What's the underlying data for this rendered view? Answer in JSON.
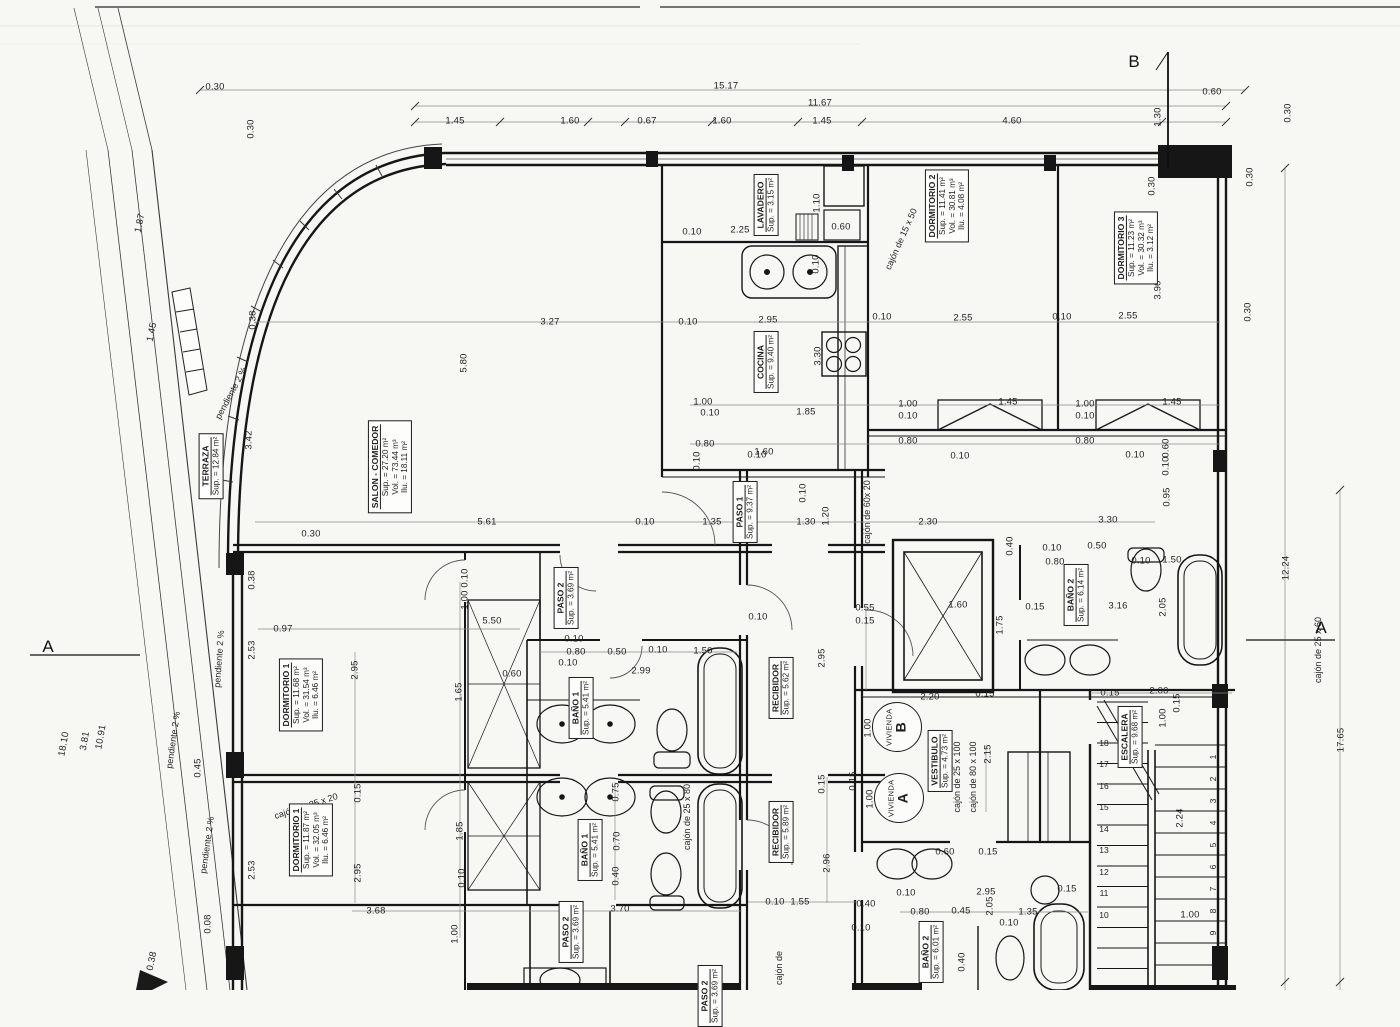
{
  "sheet": {
    "kind": "floor plan scan"
  },
  "section_letters": [
    {
      "t": "B",
      "x": 1134,
      "y": 62
    },
    {
      "t": "A",
      "x": 48,
      "y": 647
    },
    {
      "t": "A",
      "x": 1321,
      "y": 628
    }
  ],
  "rooms": [
    {
      "id": "terraza",
      "name": "TERRAZA",
      "lines": [
        "Sup. = 12.84 m²"
      ],
      "x": 211,
      "y": 466
    },
    {
      "id": "salon-comedor",
      "name": "SALON - COMEDOR",
      "lines": [
        "Sup. = 27.20 m²",
        "Vol. = 73.44 m³",
        "Ilu. = 18.11 m²"
      ],
      "x": 390,
      "y": 467
    },
    {
      "id": "lavadero",
      "name": "LAVADERO",
      "lines": [
        "Sup. = 3.15 m²"
      ],
      "x": 766,
      "y": 205
    },
    {
      "id": "cocina",
      "name": "COCINA",
      "lines": [
        "Sup. = 9.40 m²"
      ],
      "x": 766,
      "y": 362
    },
    {
      "id": "dormitorio-2",
      "name": "DORMITORIO 2",
      "lines": [
        "Sup. = 11.41 m²",
        "Vol. = 30.81 m³",
        "Ilu. = 4.08 m²"
      ],
      "x": 947,
      "y": 206
    },
    {
      "id": "dormitorio-3",
      "name": "DORMITORIO 3",
      "lines": [
        "Sup. = 11.23 m²",
        "Vol. = 30.32 m³",
        "Ilu. = 3.12 m²"
      ],
      "x": 1136,
      "y": 248
    },
    {
      "id": "paso-1",
      "name": "PASO 1",
      "lines": [
        "Sup. = 9.37 m²"
      ],
      "x": 745,
      "y": 512
    },
    {
      "id": "paso-2-b",
      "name": "PASO 2",
      "lines": [
        "Sup. = 3.69 m²"
      ],
      "x": 566,
      "y": 598
    },
    {
      "id": "bano-1-b",
      "name": "BAÑO 1",
      "lines": [
        "Sup. = 5.41 m²"
      ],
      "x": 581,
      "y": 708
    },
    {
      "id": "bano-2-b",
      "name": "BAÑO 2",
      "lines": [
        "Sup. = 6.14 m²"
      ],
      "x": 1076,
      "y": 595
    },
    {
      "id": "recibidor-b",
      "name": "RECIBIDOR",
      "lines": [
        "Sup. = 5.62 m²"
      ],
      "x": 781,
      "y": 688
    },
    {
      "id": "vestibulo",
      "name": "VESTIBULO",
      "lines": [
        "Sup. = 4.73 m²"
      ],
      "x": 940,
      "y": 761
    },
    {
      "id": "escalera",
      "name": "ESCALERA",
      "lines": [
        "Sup. = 9.68 m²"
      ],
      "x": 1130,
      "y": 737
    },
    {
      "id": "dormitorio-1-b",
      "name": "DORMITORIO 1",
      "lines": [
        "Sup. = 11.68 m²",
        "Vol. = 31.54 m³",
        "Ilu. = 6.46 m²"
      ],
      "x": 301,
      "y": 695
    },
    {
      "id": "dormitorio-1-a",
      "name": "DORMITORIO 1",
      "lines": [
        "Sup. = 11.87 m²",
        "Vol. = 32.05 m³",
        "Ilu. = 6.46 m²"
      ],
      "x": 311,
      "y": 840
    },
    {
      "id": "bano-1-a",
      "name": "BAÑO 1",
      "lines": [
        "Sup. = 5.41 m²"
      ],
      "x": 590,
      "y": 850
    },
    {
      "id": "recibidor-a",
      "name": "RECIBIDOR",
      "lines": [
        "Sup. = 5.89 m²"
      ],
      "x": 781,
      "y": 832
    },
    {
      "id": "paso-2-a",
      "name": "PASO 2",
      "lines": [
        "Sup. = 3.69 m²"
      ],
      "x": 571,
      "y": 932
    },
    {
      "id": "bano-2-a",
      "name": "BAÑO 2",
      "lines": [
        "Sup. = 6.01 m²"
      ],
      "x": 931,
      "y": 952
    },
    {
      "id": "paso-cut",
      "name": "PASO 2",
      "lines": [
        "Sup. = 3.69 m²"
      ],
      "x": 710,
      "y": 996
    }
  ],
  "unit_badges": [
    {
      "label": "VIVIENDA",
      "letter": "B",
      "x": 897,
      "y": 727
    },
    {
      "label": "VIVIENDA",
      "letter": "A",
      "x": 899,
      "y": 798
    }
  ],
  "cajones": [
    {
      "t": "cajón de  15 x 50",
      "x": 901,
      "y": 239,
      "r": -66
    },
    {
      "t": "cajón de  60x 20",
      "x": 867,
      "y": 512,
      "r": -90
    },
    {
      "t": "cajón de  80 x 100",
      "x": 973,
      "y": 777,
      "r": -90
    },
    {
      "t": "cajón de  25 x 100",
      "x": 957,
      "y": 777,
      "r": -90
    },
    {
      "t": "cajón de  25 x 80",
      "x": 687,
      "y": 817,
      "r": -90
    },
    {
      "t": "cajón de  25 x 20",
      "x": 306,
      "y": 806,
      "r": -18
    },
    {
      "t": "cajón de  25 x 60",
      "x": 1318,
      "y": 650,
      "r": -90
    },
    {
      "t": "cajón de",
      "x": 779,
      "y": 968,
      "r": -90
    }
  ],
  "slopes": [
    {
      "t": "pendiente 2 %",
      "x": 231,
      "y": 393,
      "r": -62
    },
    {
      "t": "pendiente 2 %",
      "x": 219,
      "y": 659,
      "r": -86
    },
    {
      "t": "pendiente 2 %",
      "x": 173,
      "y": 740,
      "r": -82
    },
    {
      "t": "pendiente 2 %",
      "x": 207,
      "y": 845,
      "r": -82
    }
  ],
  "stair_numbers": [
    {
      "t": "18",
      "x": 1104,
      "y": 743
    },
    {
      "t": "17",
      "x": 1104,
      "y": 764
    },
    {
      "t": "16",
      "x": 1104,
      "y": 786
    },
    {
      "t": "15",
      "x": 1104,
      "y": 807
    },
    {
      "t": "14",
      "x": 1104,
      "y": 829
    },
    {
      "t": "13",
      "x": 1104,
      "y": 850
    },
    {
      "t": "12",
      "x": 1104,
      "y": 872
    },
    {
      "t": "11",
      "x": 1104,
      "y": 893
    },
    {
      "t": "10",
      "x": 1104,
      "y": 915
    },
    {
      "t": "1",
      "x": 1213,
      "y": 757,
      "r": -90
    },
    {
      "t": "2",
      "x": 1213,
      "y": 779,
      "r": -90
    },
    {
      "t": "3",
      "x": 1213,
      "y": 801,
      "r": -90
    },
    {
      "t": "4",
      "x": 1213,
      "y": 823,
      "r": -90
    },
    {
      "t": "5",
      "x": 1213,
      "y": 845,
      "r": -90
    },
    {
      "t": "6",
      "x": 1213,
      "y": 867,
      "r": -90
    },
    {
      "t": "7",
      "x": 1213,
      "y": 889,
      "r": -90
    },
    {
      "t": "8",
      "x": 1213,
      "y": 911,
      "r": -90
    },
    {
      "t": "9",
      "x": 1213,
      "y": 933,
      "r": -90
    }
  ],
  "dims": [
    {
      "t": "0.30",
      "x": 215,
      "y": 87
    },
    {
      "t": "15.17",
      "x": 726,
      "y": 86
    },
    {
      "t": "0.60",
      "x": 1212,
      "y": 92
    },
    {
      "t": "11.67",
      "x": 820,
      "y": 103
    },
    {
      "t": "1.45",
      "x": 455,
      "y": 121
    },
    {
      "t": "1.60",
      "x": 570,
      "y": 121
    },
    {
      "t": "0.67",
      "x": 647,
      "y": 121
    },
    {
      "t": "1.60",
      "x": 722,
      "y": 121
    },
    {
      "t": "1.45",
      "x": 822,
      "y": 121
    },
    {
      "t": "4.60",
      "x": 1012,
      "y": 121
    },
    {
      "t": "0.30",
      "x": 251,
      "y": 129,
      "r": -90
    },
    {
      "t": "1.30",
      "x": 1158,
      "y": 117,
      "r": -90
    },
    {
      "t": "0.30",
      "x": 1288,
      "y": 113,
      "r": -90
    },
    {
      "t": "0.30",
      "x": 1152,
      "y": 186,
      "r": -90
    },
    {
      "t": "3.90",
      "x": 1158,
      "y": 290,
      "r": -90
    },
    {
      "t": "0.30",
      "x": 1248,
      "y": 312,
      "r": -90
    },
    {
      "t": "0.30",
      "x": 1250,
      "y": 177,
      "r": -90
    },
    {
      "t": "1.87",
      "x": 140,
      "y": 223,
      "r": -78
    },
    {
      "t": "1.45",
      "x": 152,
      "y": 332,
      "r": -78
    },
    {
      "t": "0.10",
      "x": 692,
      "y": 232
    },
    {
      "t": "2.25",
      "x": 740,
      "y": 230
    },
    {
      "t": "1.10",
      "x": 817,
      "y": 203,
      "r": -90
    },
    {
      "t": "0.60",
      "x": 841,
      "y": 227
    },
    {
      "t": "0.10",
      "x": 816,
      "y": 264,
      "r": -90
    },
    {
      "t": "0.38",
      "x": 253,
      "y": 320,
      "r": -90
    },
    {
      "t": "3.27",
      "x": 550,
      "y": 322
    },
    {
      "t": "0.10",
      "x": 688,
      "y": 322
    },
    {
      "t": "2.95",
      "x": 768,
      "y": 320
    },
    {
      "t": "0.10",
      "x": 882,
      "y": 317
    },
    {
      "t": "2.55",
      "x": 963,
      "y": 318
    },
    {
      "t": "0.10",
      "x": 1062,
      "y": 317
    },
    {
      "t": "2.55",
      "x": 1128,
      "y": 316
    },
    {
      "t": "5.80",
      "x": 464,
      "y": 363,
      "r": -90
    },
    {
      "t": "3.30",
      "x": 818,
      "y": 356,
      "r": -90
    },
    {
      "t": "3.42",
      "x": 249,
      "y": 440,
      "r": -90
    },
    {
      "t": "1.00",
      "x": 703,
      "y": 402
    },
    {
      "t": "0.10",
      "x": 710,
      "y": 413
    },
    {
      "t": "1.85",
      "x": 806,
      "y": 412
    },
    {
      "t": "1.00",
      "x": 908,
      "y": 404
    },
    {
      "t": "0.10",
      "x": 908,
      "y": 416
    },
    {
      "t": "1.45",
      "x": 1008,
      "y": 402
    },
    {
      "t": "1.00",
      "x": 1085,
      "y": 404
    },
    {
      "t": "0.10",
      "x": 1085,
      "y": 416
    },
    {
      "t": "1.45",
      "x": 1172,
      "y": 402
    },
    {
      "t": "0.80",
      "x": 705,
      "y": 444
    },
    {
      "t": "0.10",
      "x": 697,
      "y": 461,
      "r": -90
    },
    {
      "t": "1.60",
      "x": 764,
      "y": 452
    },
    {
      "t": "0.80",
      "x": 908,
      "y": 441
    },
    {
      "t": "0.10",
      "x": 960,
      "y": 456
    },
    {
      "t": "0.80",
      "x": 1085,
      "y": 441
    },
    {
      "t": "0.10",
      "x": 1135,
      "y": 455
    },
    {
      "t": "0.60",
      "x": 1166,
      "y": 448,
      "r": -90
    },
    {
      "t": "0.10",
      "x": 1166,
      "y": 466,
      "r": -90
    },
    {
      "t": "0.95",
      "x": 1167,
      "y": 497,
      "r": -90
    },
    {
      "t": "0.30",
      "x": 311,
      "y": 534
    },
    {
      "t": "5.61",
      "x": 487,
      "y": 522
    },
    {
      "t": "0.10",
      "x": 645,
      "y": 522
    },
    {
      "t": "1.35",
      "x": 712,
      "y": 522
    },
    {
      "t": "1.30",
      "x": 806,
      "y": 522
    },
    {
      "t": "1.20",
      "x": 826,
      "y": 516,
      "r": -90
    },
    {
      "t": "0.10",
      "x": 803,
      "y": 493,
      "r": -90
    },
    {
      "t": "2.30",
      "x": 928,
      "y": 522
    },
    {
      "t": "3.30",
      "x": 1108,
      "y": 520
    },
    {
      "t": "0.10",
      "x": 757,
      "y": 455
    },
    {
      "t": "0.38",
      "x": 252,
      "y": 580,
      "r": -90
    },
    {
      "t": "0.40",
      "x": 1010,
      "y": 546,
      "r": -90
    },
    {
      "t": "0.10",
      "x": 1052,
      "y": 548
    },
    {
      "t": "0.50",
      "x": 1097,
      "y": 546
    },
    {
      "t": "0.80",
      "x": 1055,
      "y": 562
    },
    {
      "t": "0.10",
      "x": 1141,
      "y": 561
    },
    {
      "t": "1.50",
      "x": 1172,
      "y": 560
    },
    {
      "t": "0.55",
      "x": 865,
      "y": 608
    },
    {
      "t": "0.15",
      "x": 865,
      "y": 621
    },
    {
      "t": "1.60",
      "x": 958,
      "y": 605
    },
    {
      "t": "1.75",
      "x": 1000,
      "y": 625,
      "r": -90
    },
    {
      "t": "0.15",
      "x": 1035,
      "y": 607
    },
    {
      "t": "3.16",
      "x": 1118,
      "y": 606
    },
    {
      "t": "2.05",
      "x": 1163,
      "y": 607,
      "r": -90
    },
    {
      "t": "0.97",
      "x": 283,
      "y": 629
    },
    {
      "t": "5.50",
      "x": 492,
      "y": 621
    },
    {
      "t": "2.95",
      "x": 355,
      "y": 670,
      "r": -90
    },
    {
      "t": "1.00",
      "x": 465,
      "y": 600,
      "r": -90
    },
    {
      "t": "0.10",
      "x": 465,
      "y": 578,
      "r": -90
    },
    {
      "t": "0.60",
      "x": 512,
      "y": 674
    },
    {
      "t": "1.65",
      "x": 459,
      "y": 692,
      "r": -90
    },
    {
      "t": "0.10",
      "x": 574,
      "y": 639
    },
    {
      "t": "0.80",
      "x": 576,
      "y": 652
    },
    {
      "t": "0.50",
      "x": 617,
      "y": 652
    },
    {
      "t": "0.10",
      "x": 658,
      "y": 650
    },
    {
      "t": "1.50",
      "x": 703,
      "y": 651
    },
    {
      "t": "0.10",
      "x": 568,
      "y": 663
    },
    {
      "t": "2.99",
      "x": 641,
      "y": 671
    },
    {
      "t": "0.10",
      "x": 758,
      "y": 617
    },
    {
      "t": "2.95",
      "x": 822,
      "y": 658,
      "r": -90
    },
    {
      "t": "2.20",
      "x": 930,
      "y": 697
    },
    {
      "t": "0.15",
      "x": 985,
      "y": 694
    },
    {
      "t": "1.00",
      "x": 868,
      "y": 728,
      "r": -90
    },
    {
      "t": "1.00",
      "x": 870,
      "y": 799,
      "r": -90
    },
    {
      "t": "0.15",
      "x": 853,
      "y": 781,
      "r": -90
    },
    {
      "t": "0.15",
      "x": 822,
      "y": 784,
      "r": -90
    },
    {
      "t": "2.15",
      "x": 988,
      "y": 754,
      "r": -90
    },
    {
      "t": "0.15",
      "x": 1110,
      "y": 693
    },
    {
      "t": "2.00",
      "x": 1159,
      "y": 691
    },
    {
      "t": "1.00",
      "x": 1163,
      "y": 718,
      "r": -90
    },
    {
      "t": "0.15",
      "x": 1177,
      "y": 703,
      "r": -90
    },
    {
      "t": "2.24",
      "x": 1180,
      "y": 818,
      "r": -90
    },
    {
      "t": "1.00",
      "x": 1190,
      "y": 915
    },
    {
      "t": "12.24",
      "x": 1286,
      "y": 568,
      "r": -90
    },
    {
      "t": "17.65",
      "x": 1341,
      "y": 740,
      "r": -90
    },
    {
      "t": "0.15",
      "x": 358,
      "y": 793,
      "r": -90
    },
    {
      "t": "2.95",
      "x": 358,
      "y": 873,
      "r": -90
    },
    {
      "t": "1.85",
      "x": 460,
      "y": 831,
      "r": -90
    },
    {
      "t": "0.10",
      "x": 462,
      "y": 878,
      "r": -90
    },
    {
      "t": "3.68",
      "x": 376,
      "y": 911
    },
    {
      "t": "1.00",
      "x": 455,
      "y": 934,
      "r": -90
    },
    {
      "t": "0.75",
      "x": 616,
      "y": 792,
      "r": -90
    },
    {
      "t": "0.70",
      "x": 617,
      "y": 841,
      "r": -90
    },
    {
      "t": "0.40",
      "x": 616,
      "y": 876,
      "r": -90
    },
    {
      "t": "3.70",
      "x": 620,
      "y": 909
    },
    {
      "t": "2.96",
      "x": 827,
      "y": 863,
      "r": -90
    },
    {
      "t": "0.10",
      "x": 775,
      "y": 902
    },
    {
      "t": "1.55",
      "x": 800,
      "y": 902
    },
    {
      "t": "0.40",
      "x": 866,
      "y": 904
    },
    {
      "t": "0.10",
      "x": 861,
      "y": 928
    },
    {
      "t": "0.10",
      "x": 906,
      "y": 893
    },
    {
      "t": "0.80",
      "x": 920,
      "y": 912
    },
    {
      "t": "0.45",
      "x": 961,
      "y": 911
    },
    {
      "t": "2.95",
      "x": 986,
      "y": 892
    },
    {
      "t": "2.05",
      "x": 990,
      "y": 906,
      "r": -90
    },
    {
      "t": "0.10",
      "x": 1009,
      "y": 923
    },
    {
      "t": "1.35",
      "x": 1028,
      "y": 912
    },
    {
      "t": "0.15",
      "x": 1067,
      "y": 889
    },
    {
      "t": "0.40",
      "x": 962,
      "y": 962,
      "r": -90
    },
    {
      "t": "0.60",
      "x": 945,
      "y": 852
    },
    {
      "t": "0.15",
      "x": 988,
      "y": 852
    },
    {
      "t": "2.53",
      "x": 252,
      "y": 650,
      "r": -90
    },
    {
      "t": "2.53",
      "x": 252,
      "y": 870,
      "r": -90
    },
    {
      "t": "0.45",
      "x": 198,
      "y": 768,
      "r": -90
    },
    {
      "t": "0.08",
      "x": 208,
      "y": 924,
      "r": -90
    },
    {
      "t": "0.38",
      "x": 152,
      "y": 961,
      "r": -78
    },
    {
      "t": "18.10",
      "x": 64,
      "y": 744,
      "r": -80
    },
    {
      "t": "3.81",
      "x": 85,
      "y": 741,
      "r": -80
    },
    {
      "t": "10.91",
      "x": 101,
      "y": 737,
      "r": -80
    }
  ]
}
